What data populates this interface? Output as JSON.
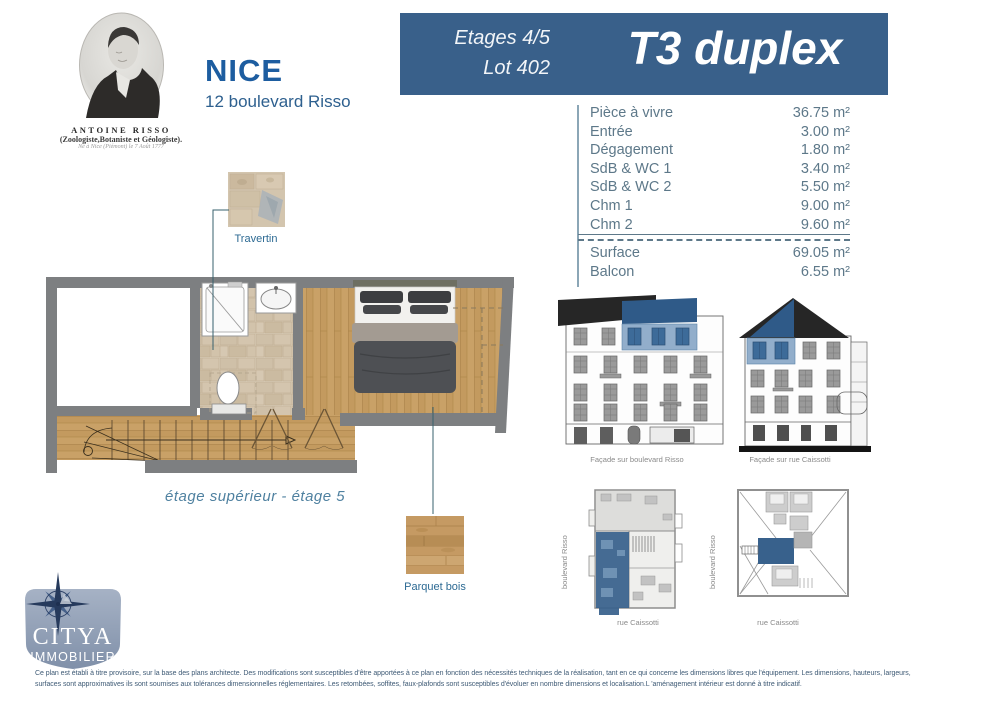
{
  "portrait": {
    "name": "ANTOINE RISSO",
    "role": "(Zoologiste,Botaniste et Géologiste).",
    "birth": "Né à Nice (Piémont) le 7 Août 1777"
  },
  "title": {
    "city": "NICE",
    "address": "12 boulevard Risso"
  },
  "banner": {
    "floors": "Etages 4/5",
    "lot": "Lot 402",
    "unit_type": "T3 duplex"
  },
  "areas": {
    "rows": [
      {
        "label": "Pièce à vivre",
        "value": "36.75 m²"
      },
      {
        "label": "Entrée",
        "value": "3.00 m²"
      },
      {
        "label": "Dégagement",
        "value": "1.80 m²"
      },
      {
        "label": "SdB & WC 1",
        "value": "3.40 m²"
      },
      {
        "label": "SdB & WC 2",
        "value": "5.50 m²"
      },
      {
        "label": "Chm 1",
        "value": "9.00 m²"
      },
      {
        "label": "Chm 2",
        "value": "9.60 m²"
      }
    ],
    "totals": [
      {
        "label": "Surface",
        "value": "69.05 m²"
      },
      {
        "label": "Balcon",
        "value": "6.55 m²"
      }
    ]
  },
  "plan": {
    "caption": "étage supérieur - étage 5",
    "travertin_label": "Travertin",
    "parquet_label": "Parquet bois"
  },
  "elevations": {
    "facade_risso": "Façade sur boulevard Risso",
    "facade_caissotti": "Façade sur rue Caissotti"
  },
  "mini_plans": {
    "bottom_street": "rue Caissotti",
    "side_street": "boulevard Risso"
  },
  "logo": {
    "name": "CITYA",
    "subtitle": "IMMOBILIER"
  },
  "footer": {
    "line1": "Ce plan est établi à titre provisoire, sur la base des plans architecte. Des modifications sont susceptibles d'être apportées à ce plan en fonction des nécessités techniques de la réalisation, tant en ce qui concerne les dimensions libres que l'équipement. Les dimensions, hauteurs, largeurs,",
    "line2": "surfaces sont approximatives ils sont soumises aux tolérances dimensionnelles réglementaires. Les retombées, soffites, faux-plafonds sont susceptibles d'évoluer en nombre dimensions et localisation.L 'aménagement intérieur est donné à titre indicatif."
  },
  "colors": {
    "banner_bg": "#39608a",
    "highlight_blue": "#2f5a88",
    "highlight_blue_light": "#92aecb",
    "wall_gray": "#7d7f81",
    "parquet": "#c9a167",
    "travertine": "#d8cbb6",
    "table_text": "#5d7889",
    "brand_shield": "#8e9db4"
  }
}
